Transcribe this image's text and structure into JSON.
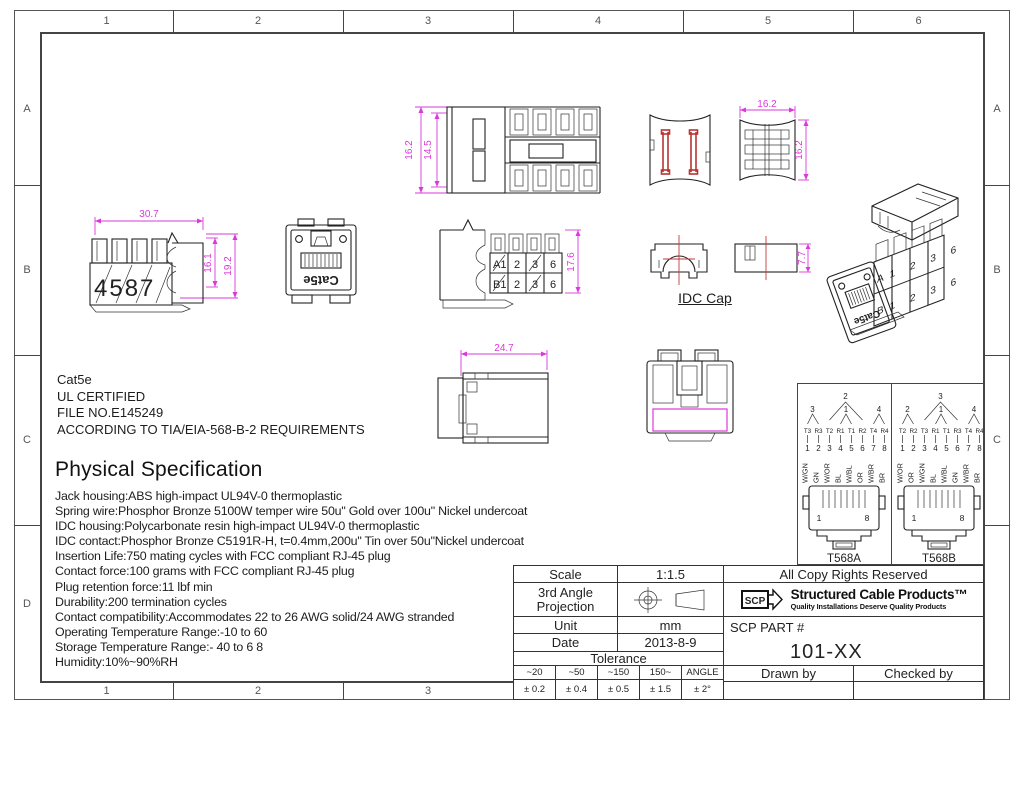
{
  "frame": {
    "top_cols": [
      "1",
      "2",
      "3",
      "4",
      "5",
      "6"
    ],
    "bottom_cols": [
      "1",
      "2",
      "3"
    ],
    "left_rows": [
      "A",
      "B",
      "C",
      "D"
    ],
    "right_rows": [
      "A",
      "B",
      "C"
    ]
  },
  "notes": {
    "line1": "Cat5e",
    "line2": "UL CERTIFIED",
    "line3": "FILE NO.E145249",
    "line4": "ACCORDING TO TIA/EIA-568-B-2 REQUIREMENTS"
  },
  "spec": {
    "title": "Physical Specification",
    "lines": [
      "Jack housing:ABS high-impact UL94V-0 thermoplastic",
      "Spring wire:Phosphor Bronze 5100W temper wire 50u\" Gold over 100u\" Nickel undercoat",
      "IDC housing:Polycarbonate resin high-impact UL94V-0 thermoplastic",
      "IDC contact:Phosphor Bronze C5191R-H, t=0.4mm,200u\" Tin over 50u\"Nickel undercoat",
      "Insertion Life:750 mating cycles with FCC compliant RJ-45 plug",
      "Contact force:100 grams with FCC compliant RJ-45 plug",
      "Plug retention force:11 lbf min",
      "Durability:200 termination cycles",
      "Contact compatibility:Accommodates 22 to 26 AWG solid/24 AWG stranded",
      "Operating Temperature Range:-10  to 60",
      "Storage Temperature Range:- 40  to 6  8",
      "Humidity:10%~90%RH"
    ]
  },
  "drawings": {
    "top_view": {
      "dim_outer": "16.2",
      "dim_inner": "14.5"
    },
    "side_view": {
      "dim_width": "30.7",
      "dim_inner_h": "16.1",
      "dim_outer_h": "19.2",
      "terminals": "4587"
    },
    "front_view": {
      "label": "Cat5e"
    },
    "right_view": {
      "dim_h": "17.6",
      "a0": "A1",
      "a1": "2",
      "a2": "3",
      "a3": "6",
      "b0": "B1",
      "b1": "2",
      "b2": "3",
      "b3": "6"
    },
    "cap_top": {
      "dim_w": "16.2",
      "dim_h": "16.2"
    },
    "cap_side": {
      "dim_h": "7.7",
      "label": "IDC Cap"
    },
    "bottom_view": {
      "dim_w": "24.7"
    },
    "iso": {
      "front_label": "Cat5e",
      "row_a": "A1 2 3 6",
      "row_b": "B1 2 3 6"
    }
  },
  "wiring": {
    "t568a": {
      "name": "T568A",
      "pair_big": "2",
      "pair_left": "3",
      "pair_mid": "1",
      "pair_right": "4",
      "tr": [
        "T3",
        "R3",
        "T2",
        "R1",
        "T1",
        "R2",
        "T4",
        "R4"
      ],
      "pins": [
        "1",
        "2",
        "3",
        "4",
        "5",
        "6",
        "7",
        "8"
      ],
      "colors": [
        "W/GN",
        "GN",
        "W/OR",
        "BL",
        "W/BL",
        "OR",
        "W/BR",
        "BR"
      ],
      "jack_first": "1",
      "jack_last": "8"
    },
    "t568b": {
      "name": "T568B",
      "pair_big": "3",
      "pair_left": "2",
      "pair_mid": "1",
      "pair_right": "4",
      "tr": [
        "T2",
        "R2",
        "T3",
        "R1",
        "T1",
        "R3",
        "T4",
        "R4"
      ],
      "pins": [
        "1",
        "2",
        "3",
        "4",
        "5",
        "6",
        "7",
        "8"
      ],
      "colors": [
        "W/OR",
        "OR",
        "W/GN",
        "BL",
        "W/BL",
        "GN",
        "W/BR",
        "BR"
      ],
      "jack_first": "1",
      "jack_last": "8"
    }
  },
  "titleblock": {
    "scale_label": "Scale",
    "scale_value": "1:1.5",
    "projection_line1": "3rd Angle",
    "projection_line2": "Projection",
    "unit_label": "Unit",
    "unit_value": "mm",
    "date_label": "Date",
    "date_value": "2013-8-9",
    "tolerance_label": "Tolerance",
    "tol_h": [
      "~20",
      "~50",
      "~150",
      "150~",
      "ANGLE"
    ],
    "tol_v": [
      "± 0.2",
      "± 0.4",
      "± 0.5",
      "± 1.5",
      "± 2°"
    ],
    "rights": "All Copy Rights Reserved",
    "logo_text": "SCP",
    "brand": "Structured Cable Products™",
    "brand_sub": "Quality Installations Deserve Quality Products",
    "part_label": "SCP PART #",
    "part_value": "101-XX",
    "drawn_label": "Drawn by",
    "checked_label": "Checked by"
  }
}
